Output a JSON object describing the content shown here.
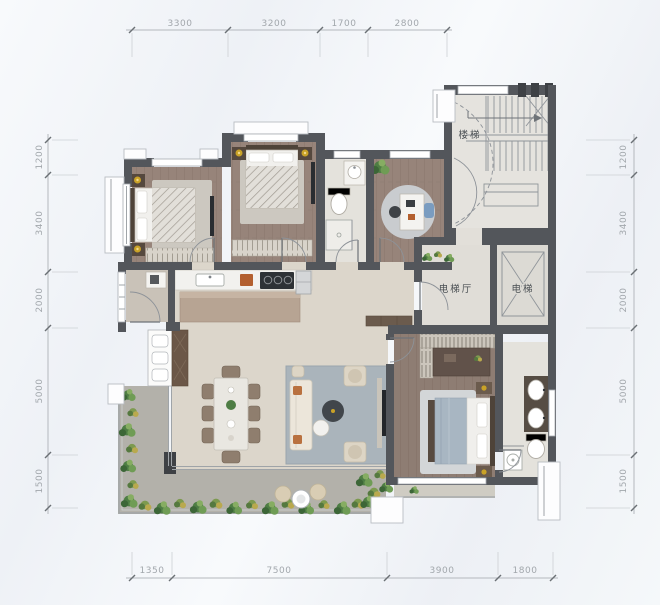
{
  "dimensions": {
    "top": [
      "3300",
      "3200",
      "1700",
      "2800"
    ],
    "bottom": [
      "1350",
      "7500",
      "3900",
      "1800"
    ],
    "left": [
      "1200",
      "3400",
      "2000",
      "5000",
      "1500"
    ],
    "right": [
      "1200",
      "3400",
      "2000",
      "5000",
      "1500"
    ]
  },
  "room_labels": {
    "stairs": "楼梯",
    "elevator_hall": "电梯厅",
    "elevator": "电梯"
  },
  "colors": {
    "wall": "#53565b",
    "wood_floor": "#98857b",
    "living_floor": "#dcd6cb",
    "balcony_floor": "#b3b1aa",
    "tile_floor": "#e4e2dc",
    "stair_floor": "#e5e3de",
    "rug_blue": "#aab4bb",
    "kitchen_island": "#b7a493",
    "plant_green": "#4e7d44",
    "accent_orange": "#b35f2e",
    "blanket_blue": "#a8b6c2",
    "gold_lamp": "#c9a227",
    "dim_text": "#a2a7ac"
  }
}
